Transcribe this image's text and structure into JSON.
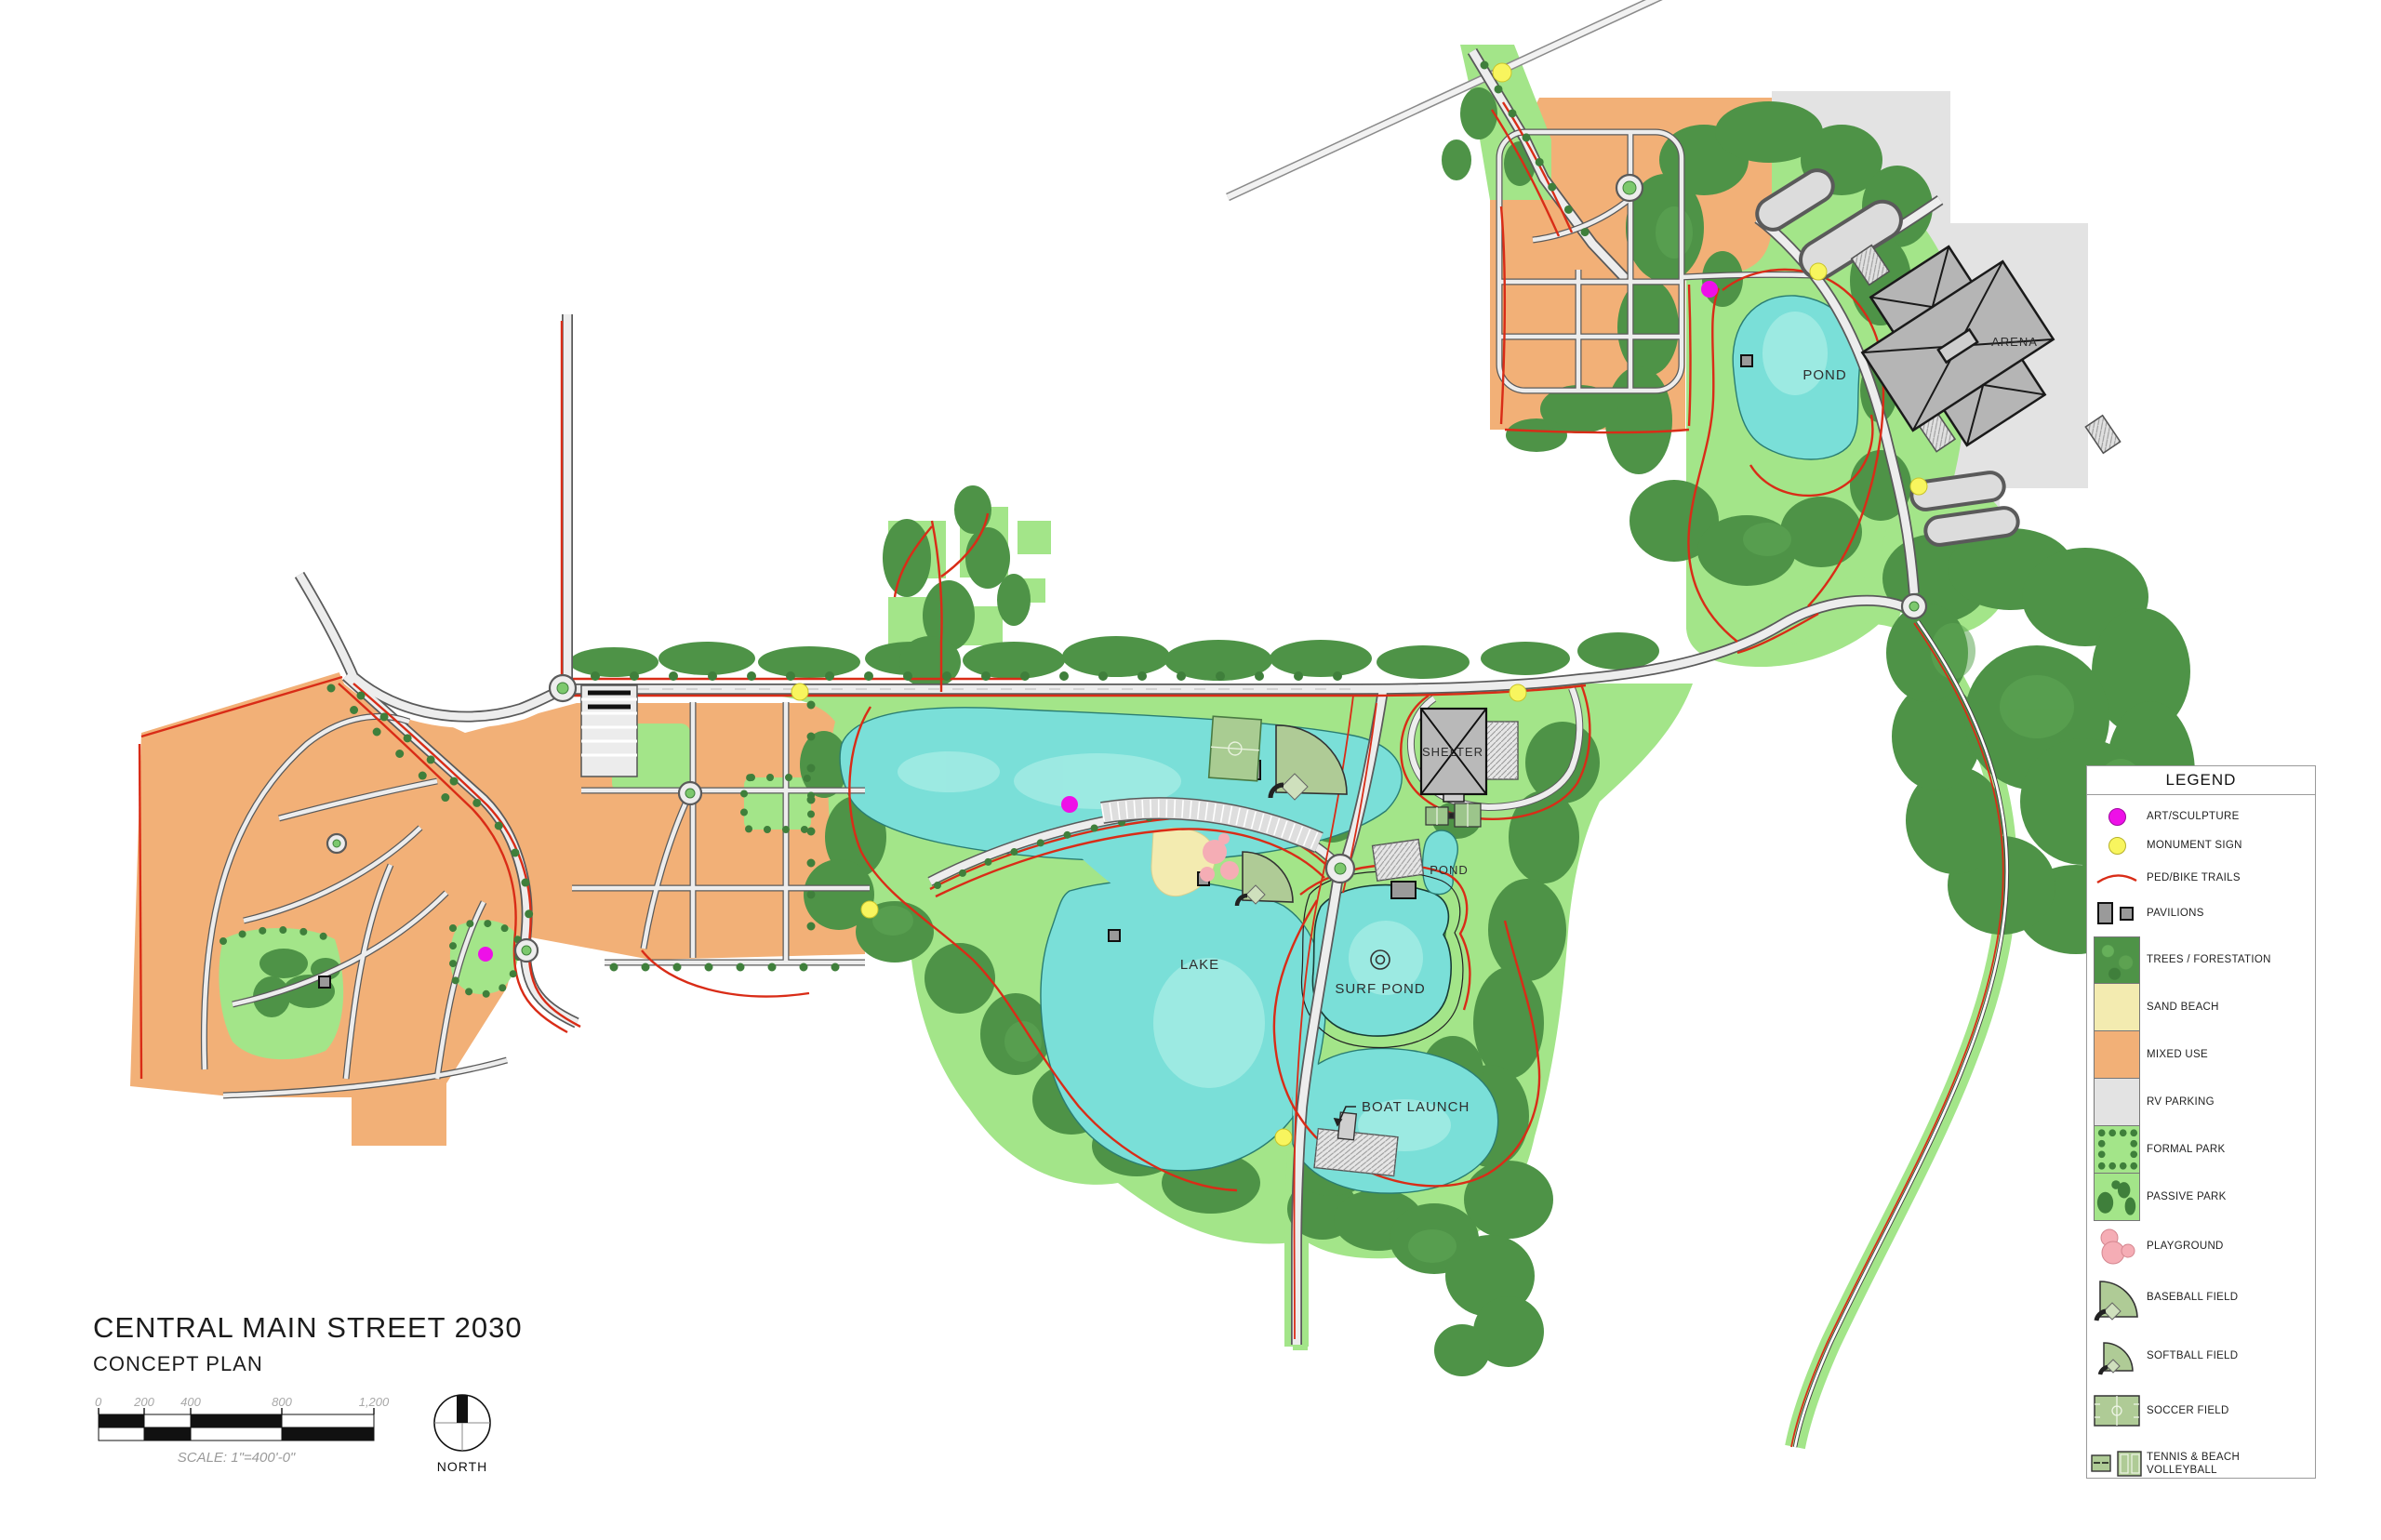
{
  "title_block": {
    "title": "CENTRAL MAIN STREET 2030",
    "subtitle": "CONCEPT PLAN",
    "scale_caption": "SCALE: 1\"=400'-0\"",
    "north_label": "NORTH",
    "scale_ticks": [
      "0",
      "200",
      "400",
      "800",
      "1,200"
    ]
  },
  "legend": {
    "title": "LEGEND",
    "items": [
      {
        "key": "art-sculpture",
        "label": "ART/SCULPTURE"
      },
      {
        "key": "monument-sign",
        "label": "MONUMENT SIGN"
      },
      {
        "key": "ped-bike-trails",
        "label": "PED/BIKE TRAILS"
      },
      {
        "key": "pavilions",
        "label": "PAVILIONS"
      },
      {
        "key": "trees-forestation",
        "label": "TREES / FORESTATION"
      },
      {
        "key": "sand-beach",
        "label": "SAND BEACH"
      },
      {
        "key": "mixed-use",
        "label": "MIXED USE"
      },
      {
        "key": "rv-parking",
        "label": "RV PARKING"
      },
      {
        "key": "formal-park",
        "label": "FORMAL PARK"
      },
      {
        "key": "passive-park",
        "label": "PASSIVE PARK"
      },
      {
        "key": "playground",
        "label": "PLAYGROUND"
      },
      {
        "key": "baseball-field",
        "label": "BASEBALL FIELD"
      },
      {
        "key": "softball-field",
        "label": "SOFTBALL FIELD"
      },
      {
        "key": "soccer-field",
        "label": "SOCCER FIELD"
      },
      {
        "key": "tennis-volleyball",
        "label": "TENNIS & BEACH VOLLEYBALL"
      }
    ]
  },
  "map": {
    "labels": [
      {
        "id": "pond-north",
        "text": "POND"
      },
      {
        "id": "arena",
        "text": "ARENA"
      },
      {
        "id": "shelter",
        "text": "SHELTER"
      },
      {
        "id": "pond-small",
        "text": "POND"
      },
      {
        "id": "lake",
        "text": "LAKE"
      },
      {
        "id": "surf-pond",
        "text": "SURF POND"
      },
      {
        "id": "boat-launch",
        "text": "BOAT LAUNCH"
      }
    ],
    "colors": {
      "water": "#7ADFD8",
      "water_light": "#AFEFE8",
      "green_park": "#A3E589",
      "forest": "#4E9347",
      "forest_light": "#5FA855",
      "mixed_use": "#F2B077",
      "rv_parking": "#E3E3E3",
      "sand": "#F3EBB0",
      "road_fill": "#EDEDED",
      "road_casing": "#5A5A5A",
      "trail_red": "#D92C17",
      "building_gray": "#B5B5B5",
      "art_magenta": "#EE10E8",
      "monument_yellow": "#F8F55E",
      "playground_pink": "#F5ADB5",
      "field_green": "#AFCB96"
    }
  }
}
